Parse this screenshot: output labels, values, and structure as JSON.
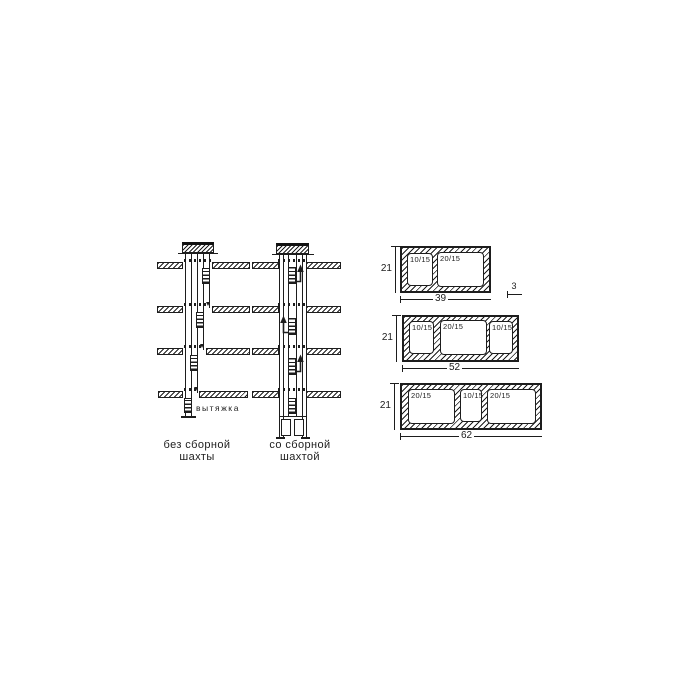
{
  "diagram": {
    "left_shaft": {
      "exhaust_label": "вытяжка",
      "caption_line1": "без сборной",
      "caption_line2": "шахты"
    },
    "right_shaft": {
      "caption_line1": "со сборной",
      "caption_line2": "шахтой"
    },
    "sections": [
      {
        "height_dim": "21",
        "width_dim": "39",
        "wall_dim": "3",
        "channels": [
          "10/15",
          "20/15"
        ]
      },
      {
        "height_dim": "21",
        "width_dim": "52",
        "channels": [
          "10/15",
          "20/15",
          "10/15"
        ]
      },
      {
        "height_dim": "21",
        "width_dim": "62",
        "channels": [
          "20/15",
          "10/15",
          "20/15"
        ]
      }
    ],
    "colors": {
      "ink": "#1d1d1d",
      "paper": "#ffffff"
    }
  }
}
